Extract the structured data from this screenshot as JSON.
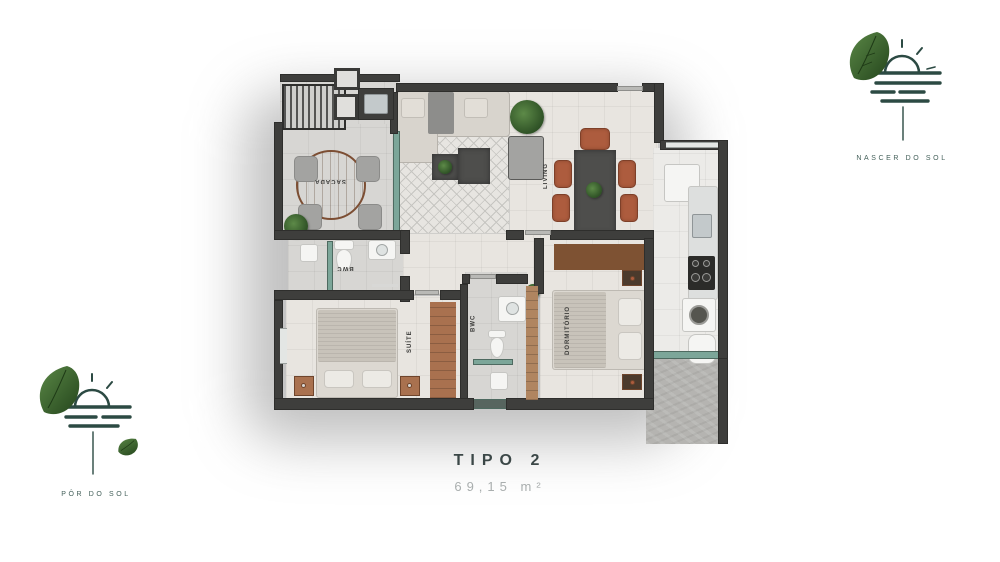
{
  "title": {
    "name": "TIPO 2",
    "area": "69,15 m²"
  },
  "logos": {
    "top_right": {
      "label": "NASCER DO SOL"
    },
    "bottom_left": {
      "label": "PÔR DO SOL"
    }
  },
  "rooms": {
    "sacada": {
      "label": "SACADA"
    },
    "living": {
      "label": "LIVING"
    },
    "bwc_suite": {
      "label": "BWC"
    },
    "suite": {
      "label": "SUÍTE"
    },
    "bwc_social": {
      "label": "BWC"
    },
    "dormitorio": {
      "label": "DORMITÓRIO"
    }
  },
  "colors": {
    "wall": "#3e3e3c",
    "glass": "#7ca699",
    "wood": "#a9714f",
    "terracotta": "#ad5c3e",
    "leaf_green": "#3c6b2e",
    "logo_ink": "#2c4a43",
    "title_ink": "#3b4747",
    "area_ink": "#a9aeae"
  }
}
